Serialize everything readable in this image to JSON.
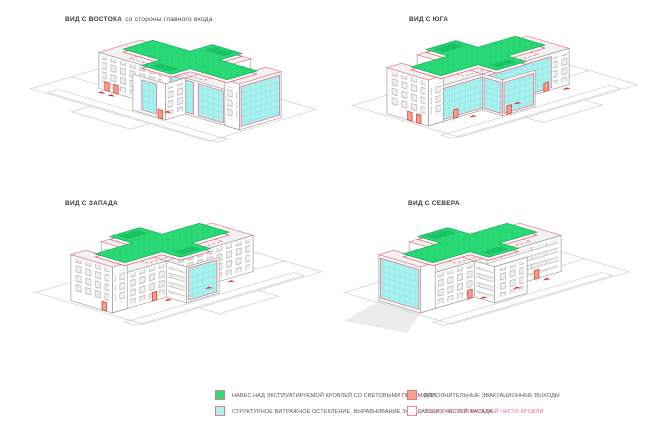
{
  "page": {
    "background": "#ffffff"
  },
  "views": [
    {
      "id": "east",
      "label": "ВИД С ВОСТОКА",
      "sublabel": "со стороны главного входа"
    },
    {
      "id": "south",
      "label": "ВИД С ЮГА",
      "sublabel": ""
    },
    {
      "id": "west",
      "label": "ВИД С ЗАПАДА",
      "sublabel": ""
    },
    {
      "id": "north",
      "label": "ВИД С СЕВЕРА",
      "sublabel": ""
    }
  ],
  "legend": {
    "items": [
      {
        "swatch": "green-solid",
        "fill": "#2bdc77",
        "border": "#ee7490",
        "label": "НАВЕС НАД ЭКСПЛУАТИРУЕМОЙ КРОВЛЕЙ СО СВЕТОВЫМИ ПРОЕМАМИ"
      },
      {
        "swatch": "cyan-solid",
        "fill": "#aef2f0",
        "border": "#ee7490",
        "label": "СТРУКТУРНОЕ ВИТРАЖНОЕ ОСТЕКЛЕНИЕ, ВЫРАВНИВАНИЕ ЗАПАДАЮЩИХ ЧАСТЕЙ ФАСАДА"
      },
      {
        "swatch": "salmon-solid",
        "fill": "#f2a48c",
        "border": "#e87184",
        "label": "ДОПОЛНИТЕЛЬНЫЕ ЭВАКУАЦИОННЫЕ ВЫХОДЫ"
      },
      {
        "swatch": "dashed-outline",
        "fill": "#ffffff",
        "border": "#ee7490",
        "label": "ЗОНА ЭКСПЛУАТИРУЕМОЙ ЧАСТИ КРОВЛИ"
      }
    ]
  },
  "colors": {
    "canopy_green": "#2bdc77",
    "glazing_cyan": "#a9f1ef",
    "accent_red": "#ee6584",
    "exit_salmon": "#f2a08a",
    "building_white": "#ffffff",
    "roof_gray": "#f2f2f0",
    "outline_gray": "#9c9c9a",
    "site_gray": "#cfcfcd"
  }
}
